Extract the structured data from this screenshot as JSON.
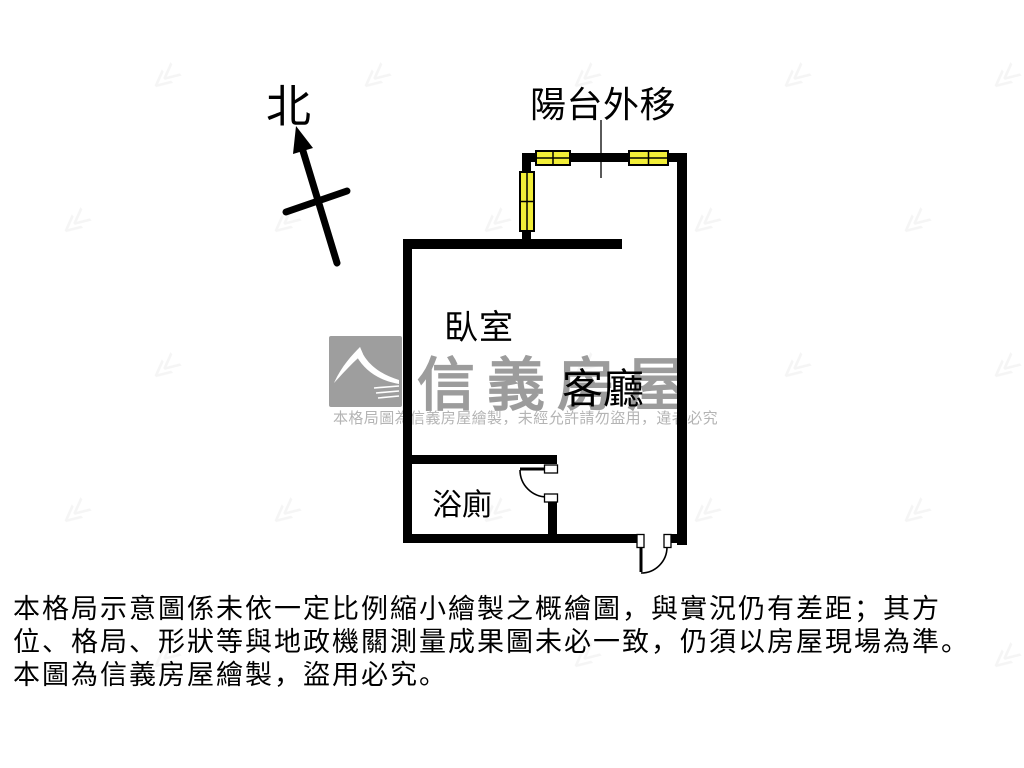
{
  "page": {
    "background": "#ffffff"
  },
  "compass": {
    "north_label": "北"
  },
  "floorplan": {
    "annotation_balcony": "陽台外移",
    "room_bedroom": "臥室",
    "room_living": "客廳",
    "room_bath": "浴廁",
    "wall_color": "#000000",
    "window_color": "#f2ee38"
  },
  "watermark": {
    "brand": "信義房屋",
    "notice": "本格局圖為信義房屋繪製，未經允許請勿盜用，違者必究",
    "brand_color": "#9c9c9c"
  },
  "disclaimer": {
    "line1": "本格局示意圖係未依一定比例縮小繪製之概繪圖，與實況仍有差距；其方",
    "line2": "位、格局、形狀等與地政機關測量成果圖未必一致，仍須以房屋現場為準。",
    "line3": "本圖為信義房屋繪製，盜用必究。"
  },
  "faint_pattern": {
    "glyph": "≪",
    "positions": [
      [
        150,
        60
      ],
      [
        360,
        60
      ],
      [
        570,
        60
      ],
      [
        780,
        60
      ],
      [
        990,
        60
      ],
      [
        60,
        205
      ],
      [
        270,
        205
      ],
      [
        480,
        205
      ],
      [
        690,
        205
      ],
      [
        900,
        205
      ],
      [
        150,
        350
      ],
      [
        360,
        350
      ],
      [
        570,
        350
      ],
      [
        780,
        350
      ],
      [
        990,
        350
      ],
      [
        60,
        495
      ],
      [
        270,
        495
      ],
      [
        480,
        495
      ],
      [
        690,
        495
      ],
      [
        900,
        495
      ],
      [
        150,
        640
      ],
      [
        570,
        640
      ],
      [
        990,
        640
      ]
    ]
  }
}
